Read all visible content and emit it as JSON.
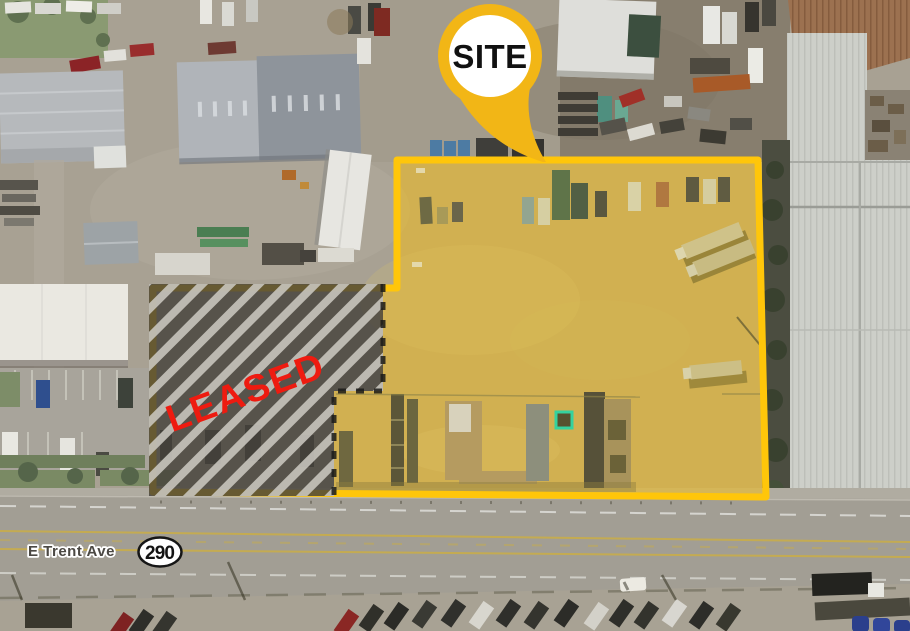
{
  "title": "Aerial site map with leased overlay",
  "callout": {
    "label": "SITE",
    "icon": "map-pin-callout"
  },
  "leased": {
    "label": "LEASED"
  },
  "road": {
    "name": "E Trent Ave",
    "route": "290"
  },
  "colors": {
    "site_outline": "#ffc60a",
    "site_fill": "rgba(255,193,7,0.47)",
    "pin": "#f2b616",
    "pin_inner": "#ffffff",
    "leased_text": "#ee1b10",
    "hatch_dark": "#45423a",
    "hatch_light": "#c9c6bf",
    "marker_teal": "#35d29e",
    "road_name_text": "#4b4843",
    "shield_text": "#141414"
  }
}
